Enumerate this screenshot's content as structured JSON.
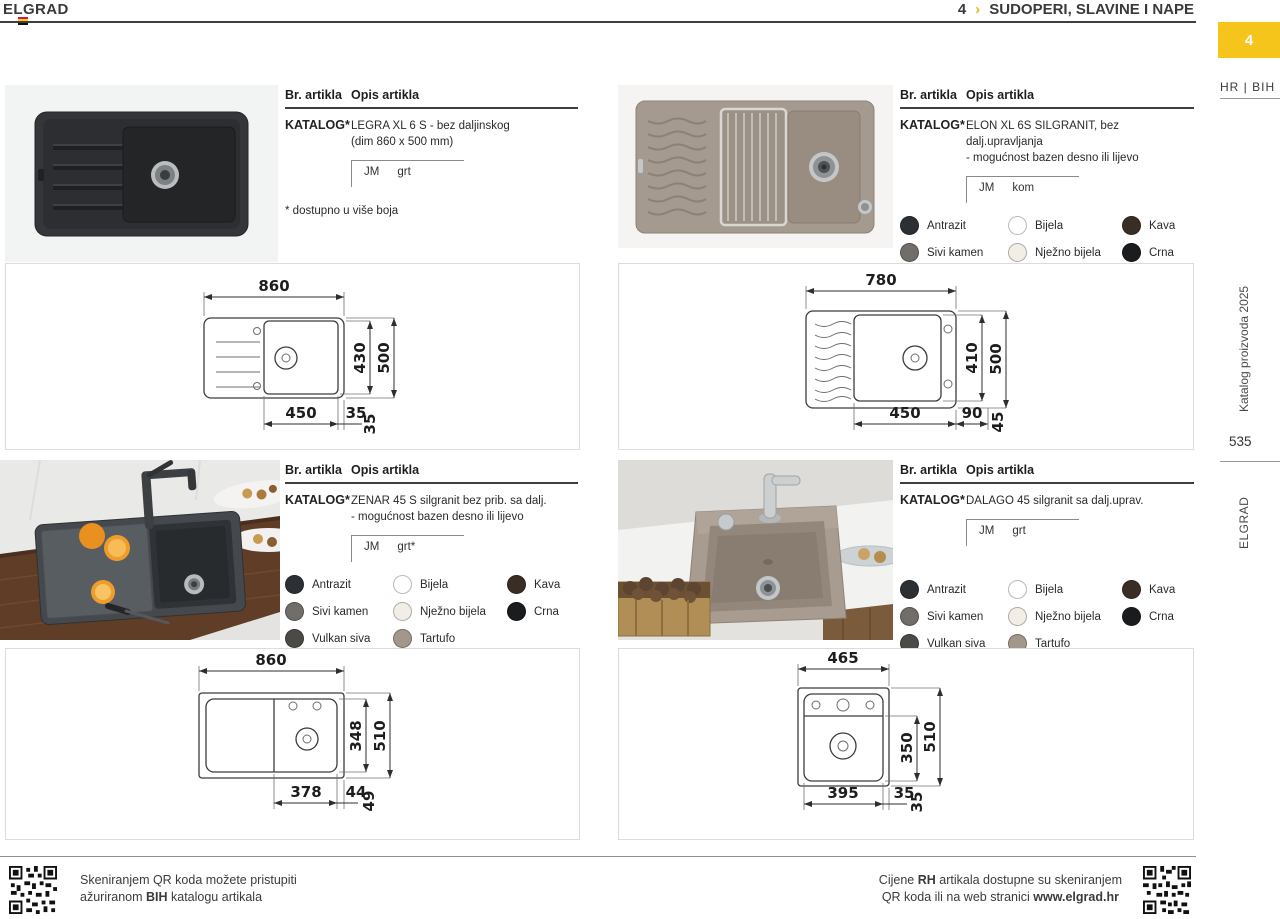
{
  "header": {
    "brand": "ELGRAD",
    "chapter_number": "4",
    "chapter_separator": "›",
    "chapter_title": "SUDOPERI, SLAVINE I NAPE"
  },
  "sidebar": {
    "tab_number": "4",
    "language": "HR | BIH",
    "edition": "Katalog proizvoda 2025",
    "page_number": "535",
    "brand": "ELGRAD",
    "accent_color": "#F6C51C"
  },
  "table_header": {
    "col_article": "Br. artikla",
    "col_description": "Opis artikla"
  },
  "colors": [
    {
      "name": "Antrazit",
      "hex": "#2c3035"
    },
    {
      "name": "Bijela",
      "hex": "#ffffff"
    },
    {
      "name": "Kava",
      "hex": "#3a2d26"
    },
    {
      "name": "Sivi kamen",
      "hex": "#716e6a"
    },
    {
      "name": "Nježno bijela",
      "hex": "#f2eee6"
    },
    {
      "name": "Crna",
      "hex": "#1b1c1e"
    },
    {
      "name": "Vulkan siva",
      "hex": "#4b4a47"
    },
    {
      "name": "Tartufo",
      "hex": "#a3968b"
    }
  ],
  "products": [
    {
      "code": "KATALOG*",
      "desc1": "LEGRA XL 6 S - bez daljinskog",
      "desc2": "(dim 860 x 500 mm)",
      "jm_label": "JM",
      "unit": "grt",
      "note": "* dostupno u više boja",
      "dims": {
        "width": "860",
        "inner_h": "430",
        "outer_h": "500",
        "b1": "450",
        "b2": "35",
        "b3": "35"
      }
    },
    {
      "code": "KATALOG*",
      "desc1": "ELON XL 6S SILGRANIT, bez dalj.upravljanja",
      "desc2": "- mogućnost bazen desno ili lijevo",
      "jm_label": "JM",
      "unit": "kom",
      "dims": {
        "width": "780",
        "inner_h": "410",
        "outer_h": "500",
        "b1": "450",
        "b2": "90",
        "b3": "45"
      }
    },
    {
      "code": "KATALOG*",
      "desc1": "ZENAR 45 S silgranit bez prib. sa dalj.",
      "desc2": "- mogućnost bazen desno ili lijevo",
      "jm_label": "JM",
      "unit": "grt*",
      "dims": {
        "width": "860",
        "inner_h": "348",
        "outer_h": "510",
        "b1": "378",
        "b2": "44",
        "b3": "49"
      }
    },
    {
      "code": "KATALOG*",
      "desc1": "DALAGO 45 silgranit sa dalj.uprav.",
      "desc2": "",
      "jm_label": "JM",
      "unit": "grt",
      "dims": {
        "width": "465",
        "inner_h": "350",
        "outer_h": "510",
        "b1": "395",
        "b2": "35",
        "b3": "35"
      }
    }
  ],
  "footer": {
    "left_line1": "Skeniranjem QR koda možete pristupiti",
    "left_line2_pre": "ažuriranom ",
    "left_line2_bold": "BIH",
    "left_line2_post": " katalogu artikala",
    "right_line1_pre": "Cijene ",
    "right_line1_bold": "RH",
    "right_line1_post": " artikala dostupne su skeniranjem",
    "right_line2_pre": "QR koda ili na web stranici ",
    "right_line2_bold": "www.elgrad.hr"
  }
}
